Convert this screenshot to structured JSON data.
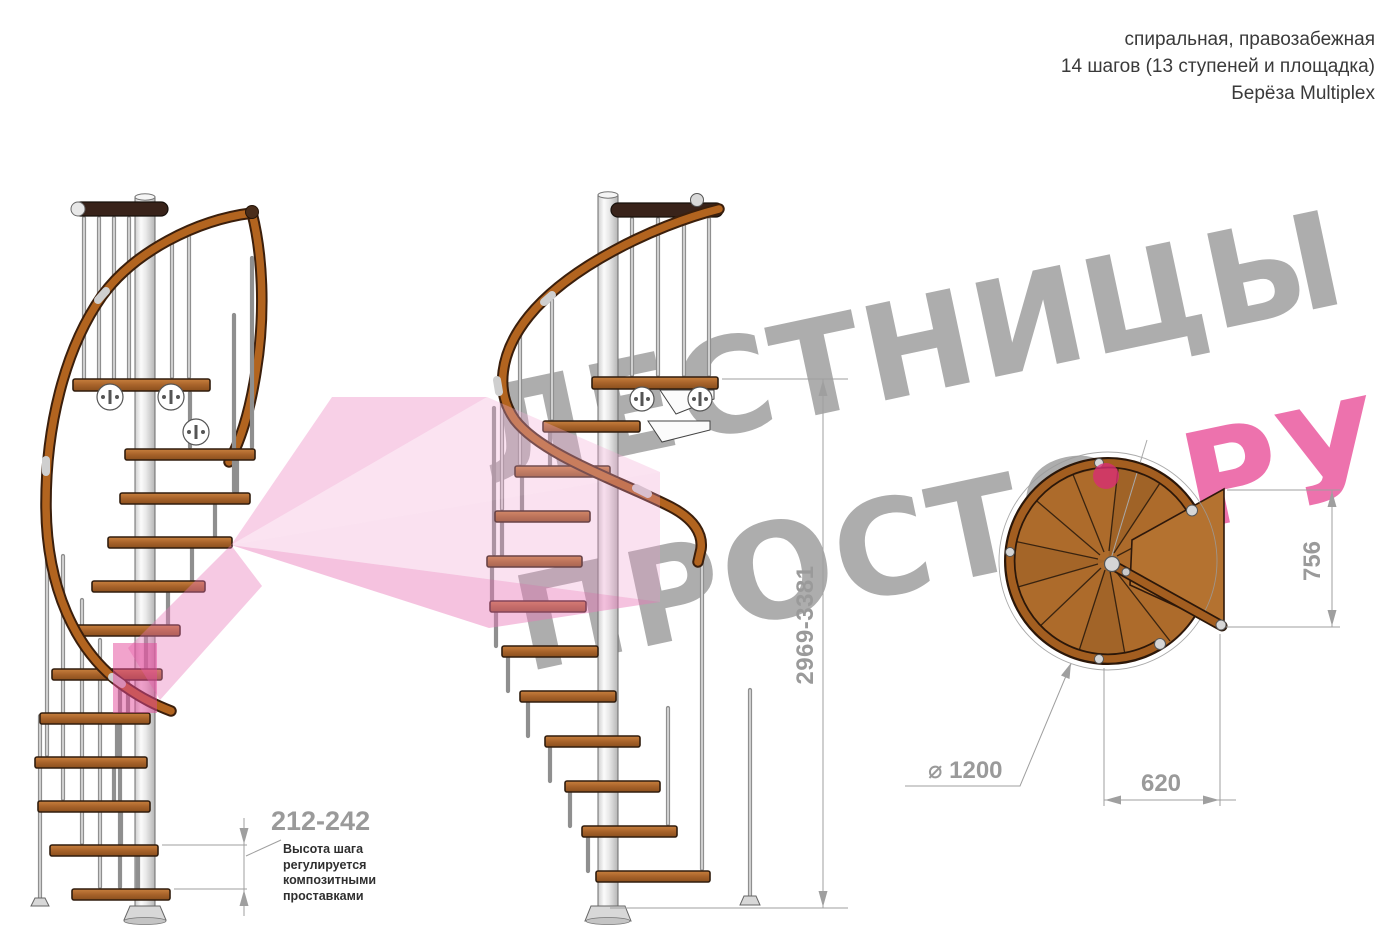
{
  "header": {
    "line1": "спиральная, правозабежная",
    "line2": "14 шагов (13 ступеней и площадка)",
    "line3": "Берёза Multiplex"
  },
  "watermark": {
    "word1": "ЛЕСТНИЦЫ",
    "word2": "ПРОСТО",
    "word2_suffix": ".РУ"
  },
  "dimensions": {
    "total_height": "2969-3381",
    "step_height": "212-242",
    "step_height_note": [
      "Высота шага",
      "регулируется",
      "композитными",
      "проставками"
    ],
    "plan_depth": "756",
    "plan_exit_width": "620",
    "diameter": "⌀ 1200"
  },
  "colors": {
    "watermark_gray": "#a7a7a7",
    "watermark_pink": "#ec67a7",
    "wood": "#ad6b2b",
    "rail_wood": "#b2641f",
    "dimension_gray": "#9f9f9f"
  }
}
